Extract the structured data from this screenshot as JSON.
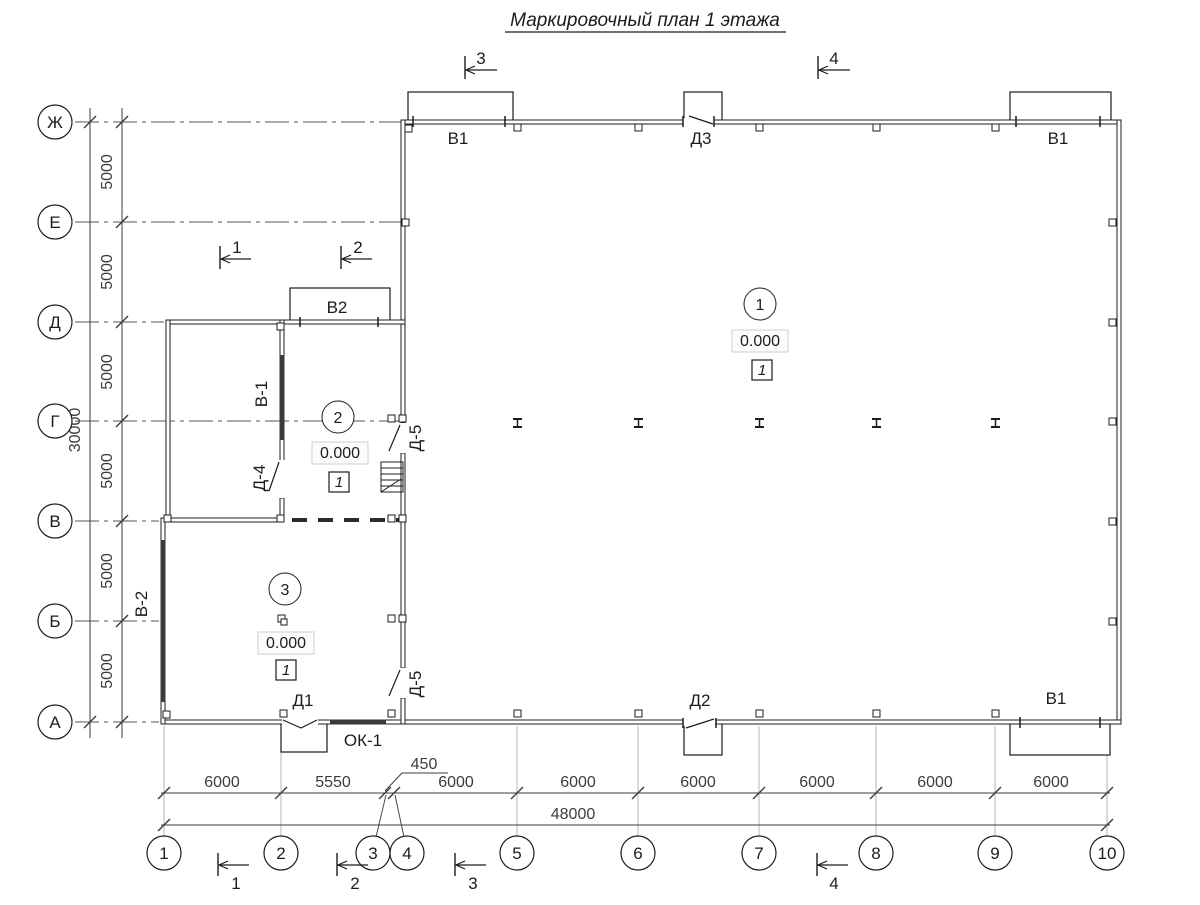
{
  "title": "Маркировочный план 1 этажа",
  "letter_axes": [
    "Ж",
    "Е",
    "Д",
    "Г",
    "В",
    "Б",
    "А"
  ],
  "number_axes": [
    "1",
    "2",
    "3",
    "4",
    "5",
    "6",
    "7",
    "8",
    "9",
    "10"
  ],
  "left_dims": {
    "segments": [
      "5000",
      "5000",
      "5000",
      "5000",
      "5000",
      "5000"
    ],
    "total": "30000"
  },
  "bottom_dims": {
    "segments": [
      "6000",
      "5550",
      "450",
      "6000",
      "6000",
      "6000",
      "6000",
      "6000",
      "6000"
    ],
    "total": "48000"
  },
  "openings": {
    "v1_top_left": "В1",
    "d3": "Д3",
    "v1_top_right": "В1",
    "v2": "В2",
    "v1_win": "В-1",
    "d4": "Д-4",
    "d5_upper": "Д-5",
    "d5_lower": "Д-5",
    "v2_win": "В-2",
    "d1": "Д1",
    "ok1": "ОК-1",
    "d2": "Д2",
    "v1_bottom": "В1"
  },
  "rooms": [
    {
      "number": "1",
      "elevation": "0.000",
      "finish_type": "1"
    },
    {
      "number": "2",
      "elevation": "0.000",
      "finish_type": "1"
    },
    {
      "number": "3",
      "elevation": "0.000",
      "finish_type": "1"
    }
  ],
  "sections": {
    "top": [
      "3",
      "4"
    ],
    "middle": [
      "1",
      "2"
    ],
    "bottom": [
      "1",
      "2",
      "3",
      "4"
    ]
  }
}
